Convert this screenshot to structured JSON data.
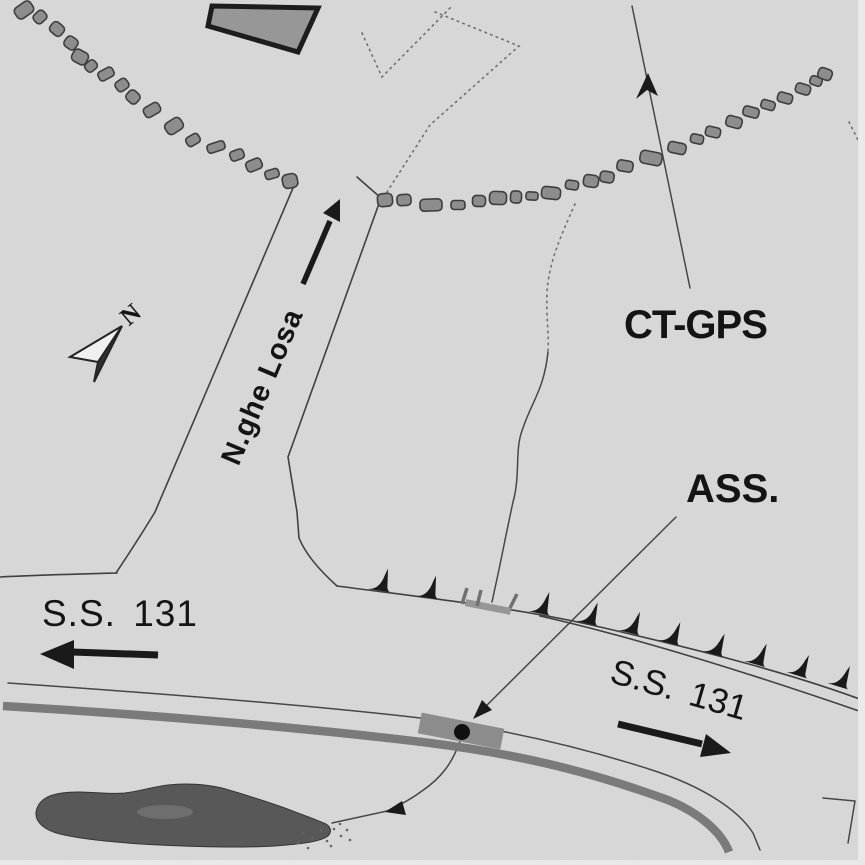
{
  "labels": {
    "ct_gps": "CT-GPS",
    "ass": "ASS.",
    "nuraghe_road": "N.ghe Losa",
    "ss131_left": "S.S. 131",
    "ss131_right": "S.S. 131",
    "north": "N"
  },
  "colors": {
    "background": "#d8d8d8",
    "ink": "#181818",
    "line": "#454545",
    "stone_fill": "#8d8d8d",
    "stone_edge": "#3c3c3c",
    "highway_band": "#7a7a7a",
    "pond_fill": "#575757",
    "building_fill": "#979797",
    "marker_rect": "#8c8c8c",
    "dotted": "#6e6e6e"
  },
  "map": {
    "paths": {
      "access_road_left": "M116,573 Q138,540 155,512 L293,188",
      "access_road_right": "M337,586 Q308,560 299,538 L297,512 L288,457 L381,198 L357,177",
      "old_road_left": "M0,577 C40,575 80,574 117,573",
      "old_road_top": "M337,586 C420,597 520,608 600,627 C700,650 790,673 865,701",
      "old_road_bottom": "M540,616 C620,634 720,663 862,712",
      "highway_edge": "M8,683 C140,692 300,704 420,718 C520,731 600,753 655,771 C700,786 737,808 753,833 L760,850",
      "highway_band": "M3,706 C140,714 300,727 430,743 C540,757 610,779 668,800 C700,813 722,833 729,852",
      "stream_upper_dotted": "M575,204 C560,238 549,262 547,292 C546,316 549,334 548,352",
      "stream_upper_solid": "M548,352 C544,390 531,403 523,428 C514,450 521,473 513,502 C506,534 500,566 495,588 L492,602",
      "stream_lower": "M461,738 C453,763 441,778 422,791 C410,800 398,806 387,811 L332,823",
      "ass_leader": "M676,517 L476,716",
      "ctgps_line": "M632,6 L690,288",
      "dotted_v": "M362,33 L382,77 L453,5",
      "dotted_zigzag": "M435,12 L519,46 L430,125 L387,192",
      "dotted_right_edge": "M849,122 L863,150",
      "corner_line": "M823,798 L855,801 L848,843",
      "access_arrow_shaft": "M303,284 L330,221",
      "ss131_left_arrow_shaft": "M72,652 L158,655",
      "ss131_right_arrow_shaft": "M618,724 L702,744",
      "pond": "M36,812 C38,800 48,795 62,793 C85,790 105,795 125,793 C140,791 152,787 168,785 C185,783 205,784 222,788 C243,794 262,800 282,807 C298,813 315,819 326,824 C331,827 332,832 328,836 C320,842 300,844 275,846 C240,848 200,847 160,845 C120,843 85,840 60,834 C44,830 35,822 36,812 Z"
    },
    "polys": {
      "access_arrow_head": "340,199 340,222 323,213",
      "ass_leader_arrow_head": "473,719 492,710 482,700",
      "stream_arrow_head": "385,812 406,815 402,801",
      "ctgps_arrow_head": "648,73 636,99 647,90 658,96",
      "ss131_left_arrow_head": "40,654 74,640 74,669",
      "ss131_right_arrow_head": "731,753 706,734 700,757",
      "north_arrow_white_half": "122,326 70,357 98,362",
      "north_arrow_dark_half": "122,326 98,362 94,382",
      "building": "212,6 318,8 298,52 208,26"
    },
    "marker": {
      "rect": {
        "x": 461,
        "y": 731,
        "w": 84,
        "h": 21,
        "rot": 11
      },
      "dot": {
        "x": 462,
        "y": 732,
        "r": 8
      }
    },
    "spike_path": "M0,0 C7,-1 12,-4 15,-17 L17,-23 L19,-4 C20,-1 21,0 23,0 Z",
    "spikes": [
      [
        368,
        589,
        8
      ],
      [
        416,
        596,
        8
      ],
      [
        528,
        611,
        12
      ],
      [
        576,
        621,
        13
      ],
      [
        618,
        630,
        14
      ],
      [
        658,
        640,
        15
      ],
      [
        702,
        651,
        16
      ],
      [
        744,
        661,
        16
      ],
      [
        786,
        672,
        17
      ],
      [
        827,
        683,
        17
      ]
    ],
    "culvert": {
      "band": {
        "x": 488,
        "y": 607,
        "w": 46,
        "h": 7,
        "rot": 11
      },
      "ticks": [
        [
          462,
          604,
          467,
          588
        ],
        [
          477,
          606,
          481,
          590
        ],
        [
          510,
          608,
          517,
          594
        ]
      ]
    },
    "stones": [
      [
        24,
        10,
        19,
        13,
        -35
      ],
      [
        40,
        17,
        13,
        11,
        -42
      ],
      [
        57,
        29,
        12,
        14,
        -50
      ],
      [
        71,
        43,
        12,
        13,
        -55
      ],
      [
        80,
        57,
        13,
        16,
        -62
      ],
      [
        91,
        66,
        12,
        10,
        -40
      ],
      [
        106,
        74,
        16,
        10,
        -28
      ],
      [
        122,
        85,
        13,
        11,
        -35
      ],
      [
        133,
        97,
        12,
        13,
        -48
      ],
      [
        152,
        110,
        17,
        11,
        -30
      ],
      [
        174,
        126,
        18,
        13,
        -33
      ],
      [
        193,
        140,
        14,
        10,
        -30
      ],
      [
        216,
        147,
        18,
        9,
        -18
      ],
      [
        237,
        155,
        14,
        10,
        -20
      ],
      [
        254,
        165,
        16,
        11,
        -22
      ],
      [
        272,
        174,
        14,
        9,
        -16
      ],
      [
        290,
        181,
        15,
        14,
        -12
      ],
      [
        385,
        200,
        15,
        13,
        -5
      ],
      [
        404,
        200,
        14,
        11,
        -4
      ],
      [
        431,
        205,
        22,
        12,
        -2
      ],
      [
        458,
        205,
        14,
        9,
        0
      ],
      [
        479,
        201,
        13,
        11,
        2
      ],
      [
        498,
        198,
        17,
        13,
        2
      ],
      [
        516,
        197,
        11,
        12,
        3
      ],
      [
        532,
        196,
        12,
        8,
        4
      ],
      [
        551,
        193,
        19,
        12,
        6
      ],
      [
        572,
        185,
        13,
        9,
        8
      ],
      [
        591,
        181,
        15,
        12,
        8
      ],
      [
        607,
        177,
        14,
        11,
        9
      ],
      [
        625,
        166,
        16,
        11,
        10
      ],
      [
        651,
        158,
        22,
        13,
        11
      ],
      [
        677,
        148,
        18,
        11,
        12
      ],
      [
        697,
        139,
        13,
        9,
        12
      ],
      [
        713,
        132,
        15,
        10,
        13
      ],
      [
        734,
        122,
        16,
        11,
        15
      ],
      [
        751,
        112,
        16,
        10,
        15
      ],
      [
        768,
        105,
        14,
        9,
        16
      ],
      [
        785,
        98,
        15,
        10,
        16
      ],
      [
        803,
        89,
        15,
        10,
        17
      ],
      [
        816,
        81,
        12,
        9,
        18
      ],
      [
        825,
        74,
        14,
        11,
        20
      ]
    ],
    "pond_dots": [
      [
        303,
        833
      ],
      [
        312,
        838
      ],
      [
        321,
        830
      ],
      [
        327,
        841
      ],
      [
        334,
        829
      ],
      [
        331,
        846
      ],
      [
        341,
        836
      ],
      [
        308,
        848
      ],
      [
        298,
        843
      ],
      [
        340,
        824
      ],
      [
        347,
        830
      ],
      [
        350,
        840
      ]
    ],
    "pond_highlight": {
      "x": 165,
      "y": 812,
      "rx": 28,
      "ry": 7
    }
  }
}
